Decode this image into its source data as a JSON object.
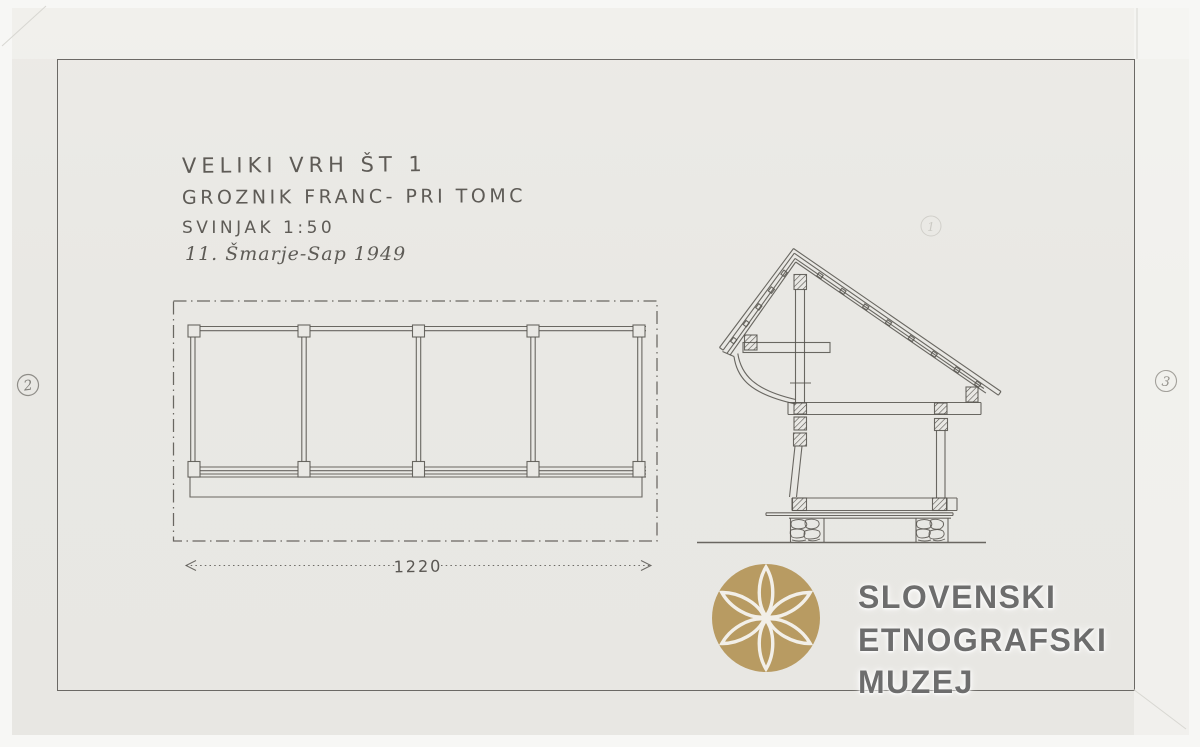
{
  "document": {
    "title_block": {
      "line1": "VELIKI VRH ŠT 1",
      "line2": "GROZNIK FRANC- PRI TOMC",
      "line3": "SVINJAK 1:50",
      "line4": "11. Šmarje-Sap 1949"
    },
    "plan": {
      "dimension_label": "1220"
    },
    "sheet_numbers": {
      "left": "2",
      "right": "3",
      "top": "1"
    }
  },
  "watermark": {
    "line1": "SLOVENSKI",
    "line2": "ETNOGRAFSKI",
    "line3": "MUZEJ",
    "logo_icon": "six-petal-rosette",
    "logo_color": "#b89b62",
    "text_color": "#6d6d6d"
  },
  "colors": {
    "pencil": "#56544f",
    "paper": "#e9e8e4",
    "scan_background": "#f7f7f5"
  }
}
